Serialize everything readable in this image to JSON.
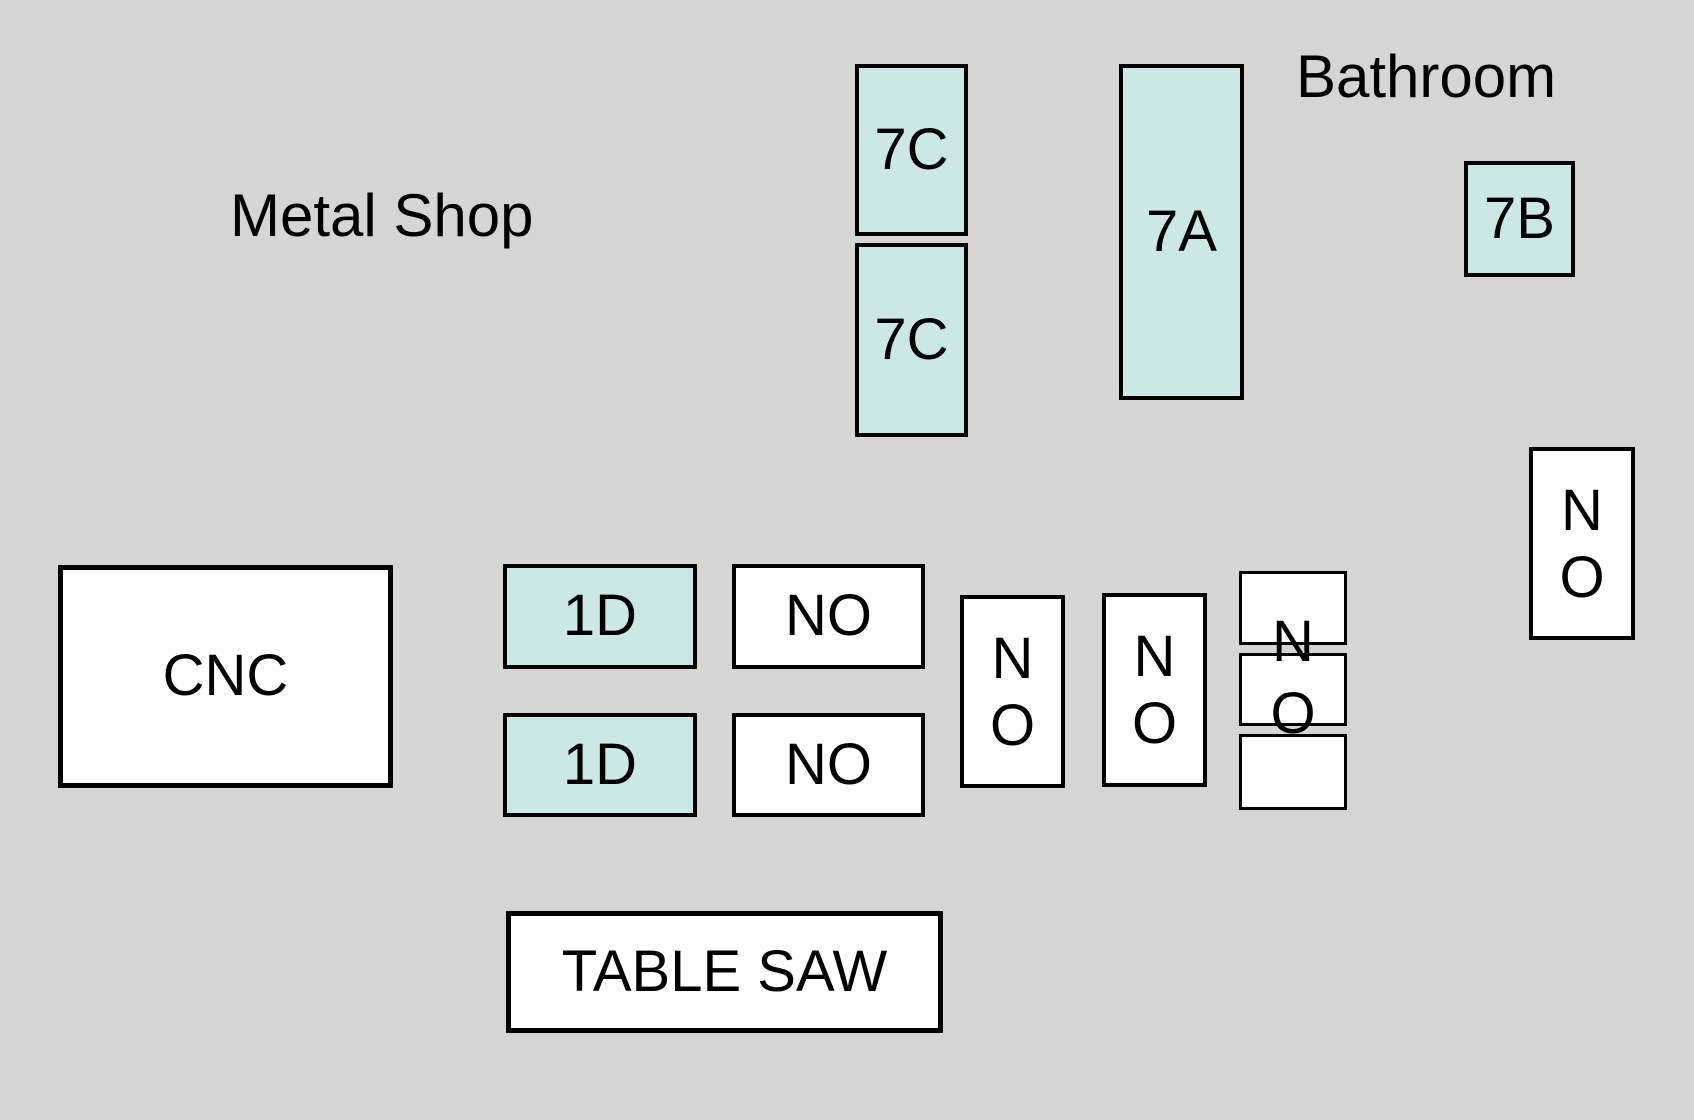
{
  "labels": {
    "metal_shop": "Metal Shop",
    "bathroom": "Bathroom"
  },
  "colors": {
    "background": "#d5d5d5",
    "highlight_fill": "#cbe8e5",
    "plain_fill": "#ffffff",
    "border": "#000000",
    "text": "#000000"
  },
  "boxes": {
    "c7_top": {
      "label": "7C"
    },
    "c7_bottom": {
      "label": "7C"
    },
    "a7": {
      "label": "7A"
    },
    "b7": {
      "label": "7B"
    },
    "cnc": {
      "label": "CNC"
    },
    "d1_top": {
      "label": "1D"
    },
    "d1_bottom": {
      "label": "1D"
    },
    "no_h_top": {
      "label": "NO"
    },
    "no_h_bottom": {
      "label": "NO"
    },
    "no_v_left": {
      "lines": [
        "N",
        "O"
      ]
    },
    "no_v_middle": {
      "lines": [
        "N",
        "O"
      ]
    },
    "no_v_right": {
      "lines": [
        "N",
        "O"
      ]
    },
    "no_stack_overlay": {
      "lines": [
        "N",
        "O"
      ]
    },
    "stack_top": {
      "label": ""
    },
    "stack_middle": {
      "label": ""
    },
    "stack_bottom": {
      "label": ""
    },
    "table_saw": {
      "label": "TABLE SAW"
    }
  }
}
